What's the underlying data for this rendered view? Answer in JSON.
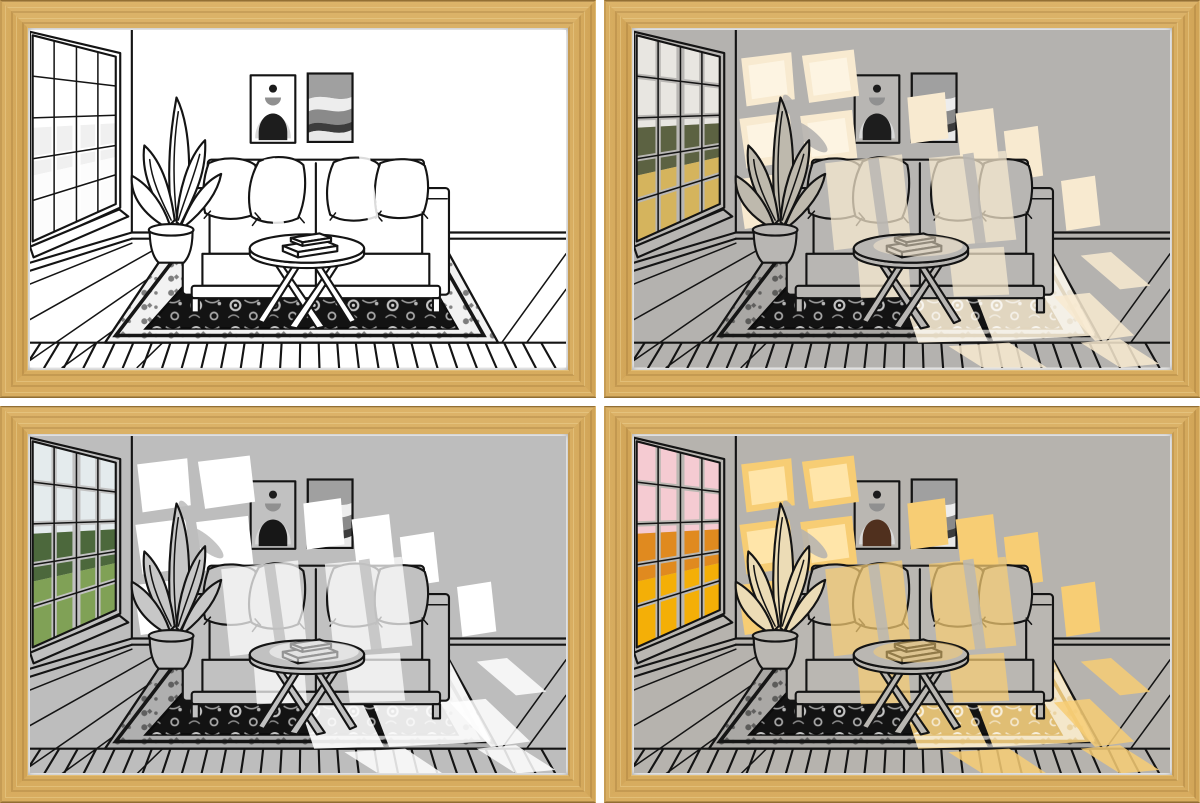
{
  "page": {
    "description": "Product image: four identical oak-framed light-painting artworks of a line-drawn living room, shown in four lighting modes",
    "background": "#ffffff",
    "grid": {
      "rows": 2,
      "cols": 2,
      "gap_px": 8
    }
  },
  "frame": {
    "material": "oak-wood",
    "wood_base": "#d2a75c",
    "wood_dark": "#ad8040",
    "wood_light": "#eacf97",
    "border_px": 28,
    "mat_color": "#ffffff"
  },
  "scene": {
    "objects": [
      "window-with-view",
      "potted-plant",
      "sofa",
      "throw-pillows",
      "wall-art-arch",
      "wall-art-waves",
      "round-coffee-table",
      "books",
      "oriental-rug",
      "plank-floor",
      "sunlight-patches"
    ],
    "rug": {
      "field": "#131313",
      "motif_light": "#c6c6c6",
      "motif_mid": "#9c9c9c"
    },
    "art_waves_grays": [
      "#dedede",
      "#a0a0a0",
      "#ededed",
      "#8a8a8a",
      "#3c3c3c",
      "#e8e8e8"
    ]
  },
  "panels": [
    {
      "id": "line-art-off",
      "mode": "light-off-white-line-art",
      "position": "top-left",
      "colors": {
        "wall": "#ffffff",
        "obj": "#ffffff",
        "plantFill": "#ffffff",
        "light": "rgba(255,255,255,0)",
        "lightCore": "rgba(255,255,255,0)",
        "sky": "#ffffff",
        "trees": "#f0f0f0",
        "field": "#fcfcfc",
        "dome": "#1d1d1d",
        "rugLight": "#f2f2f2"
      }
    },
    {
      "id": "warm-white-glow",
      "mode": "warm-cream-window-light",
      "position": "top-right",
      "colors": {
        "wall": "#b4b2af",
        "obj": "#b8b6b3",
        "plantFill": "#beb9ad",
        "light": "#f8ead0",
        "lightCore": "#fdf5e3",
        "sky": "#e8e6e1",
        "trees": "#5c6242",
        "field": "#d5b45d",
        "dome": "#1d1d1d",
        "rugLight": "#aaa8a5"
      }
    },
    {
      "id": "bright-white",
      "mode": "bright-white-window-light",
      "position": "bottom-left",
      "colors": {
        "wall": "#bdbdbd",
        "obj": "#c1c1c1",
        "plantFill": "#c7c7c7",
        "light": "#ffffff",
        "lightCore": "#ffffff",
        "sky": "#e4ebed",
        "trees": "#4c683c",
        "field": "#80a156",
        "dome": "#171717",
        "rugLight": "#afafaf"
      }
    },
    {
      "id": "golden-hour",
      "mode": "golden-sunset-light",
      "position": "bottom-right",
      "colors": {
        "wall": "#b6b3ae",
        "obj": "#bab7b2",
        "plantFill": "#ecdcb6",
        "light": "#f7cd74",
        "lightCore": "#ffe8af",
        "sky": "#f5cbd2",
        "trees": "#e08a1f",
        "field": "#f4af07",
        "dome": "#50301e",
        "rugLight": "#aaa8a5"
      }
    }
  ]
}
